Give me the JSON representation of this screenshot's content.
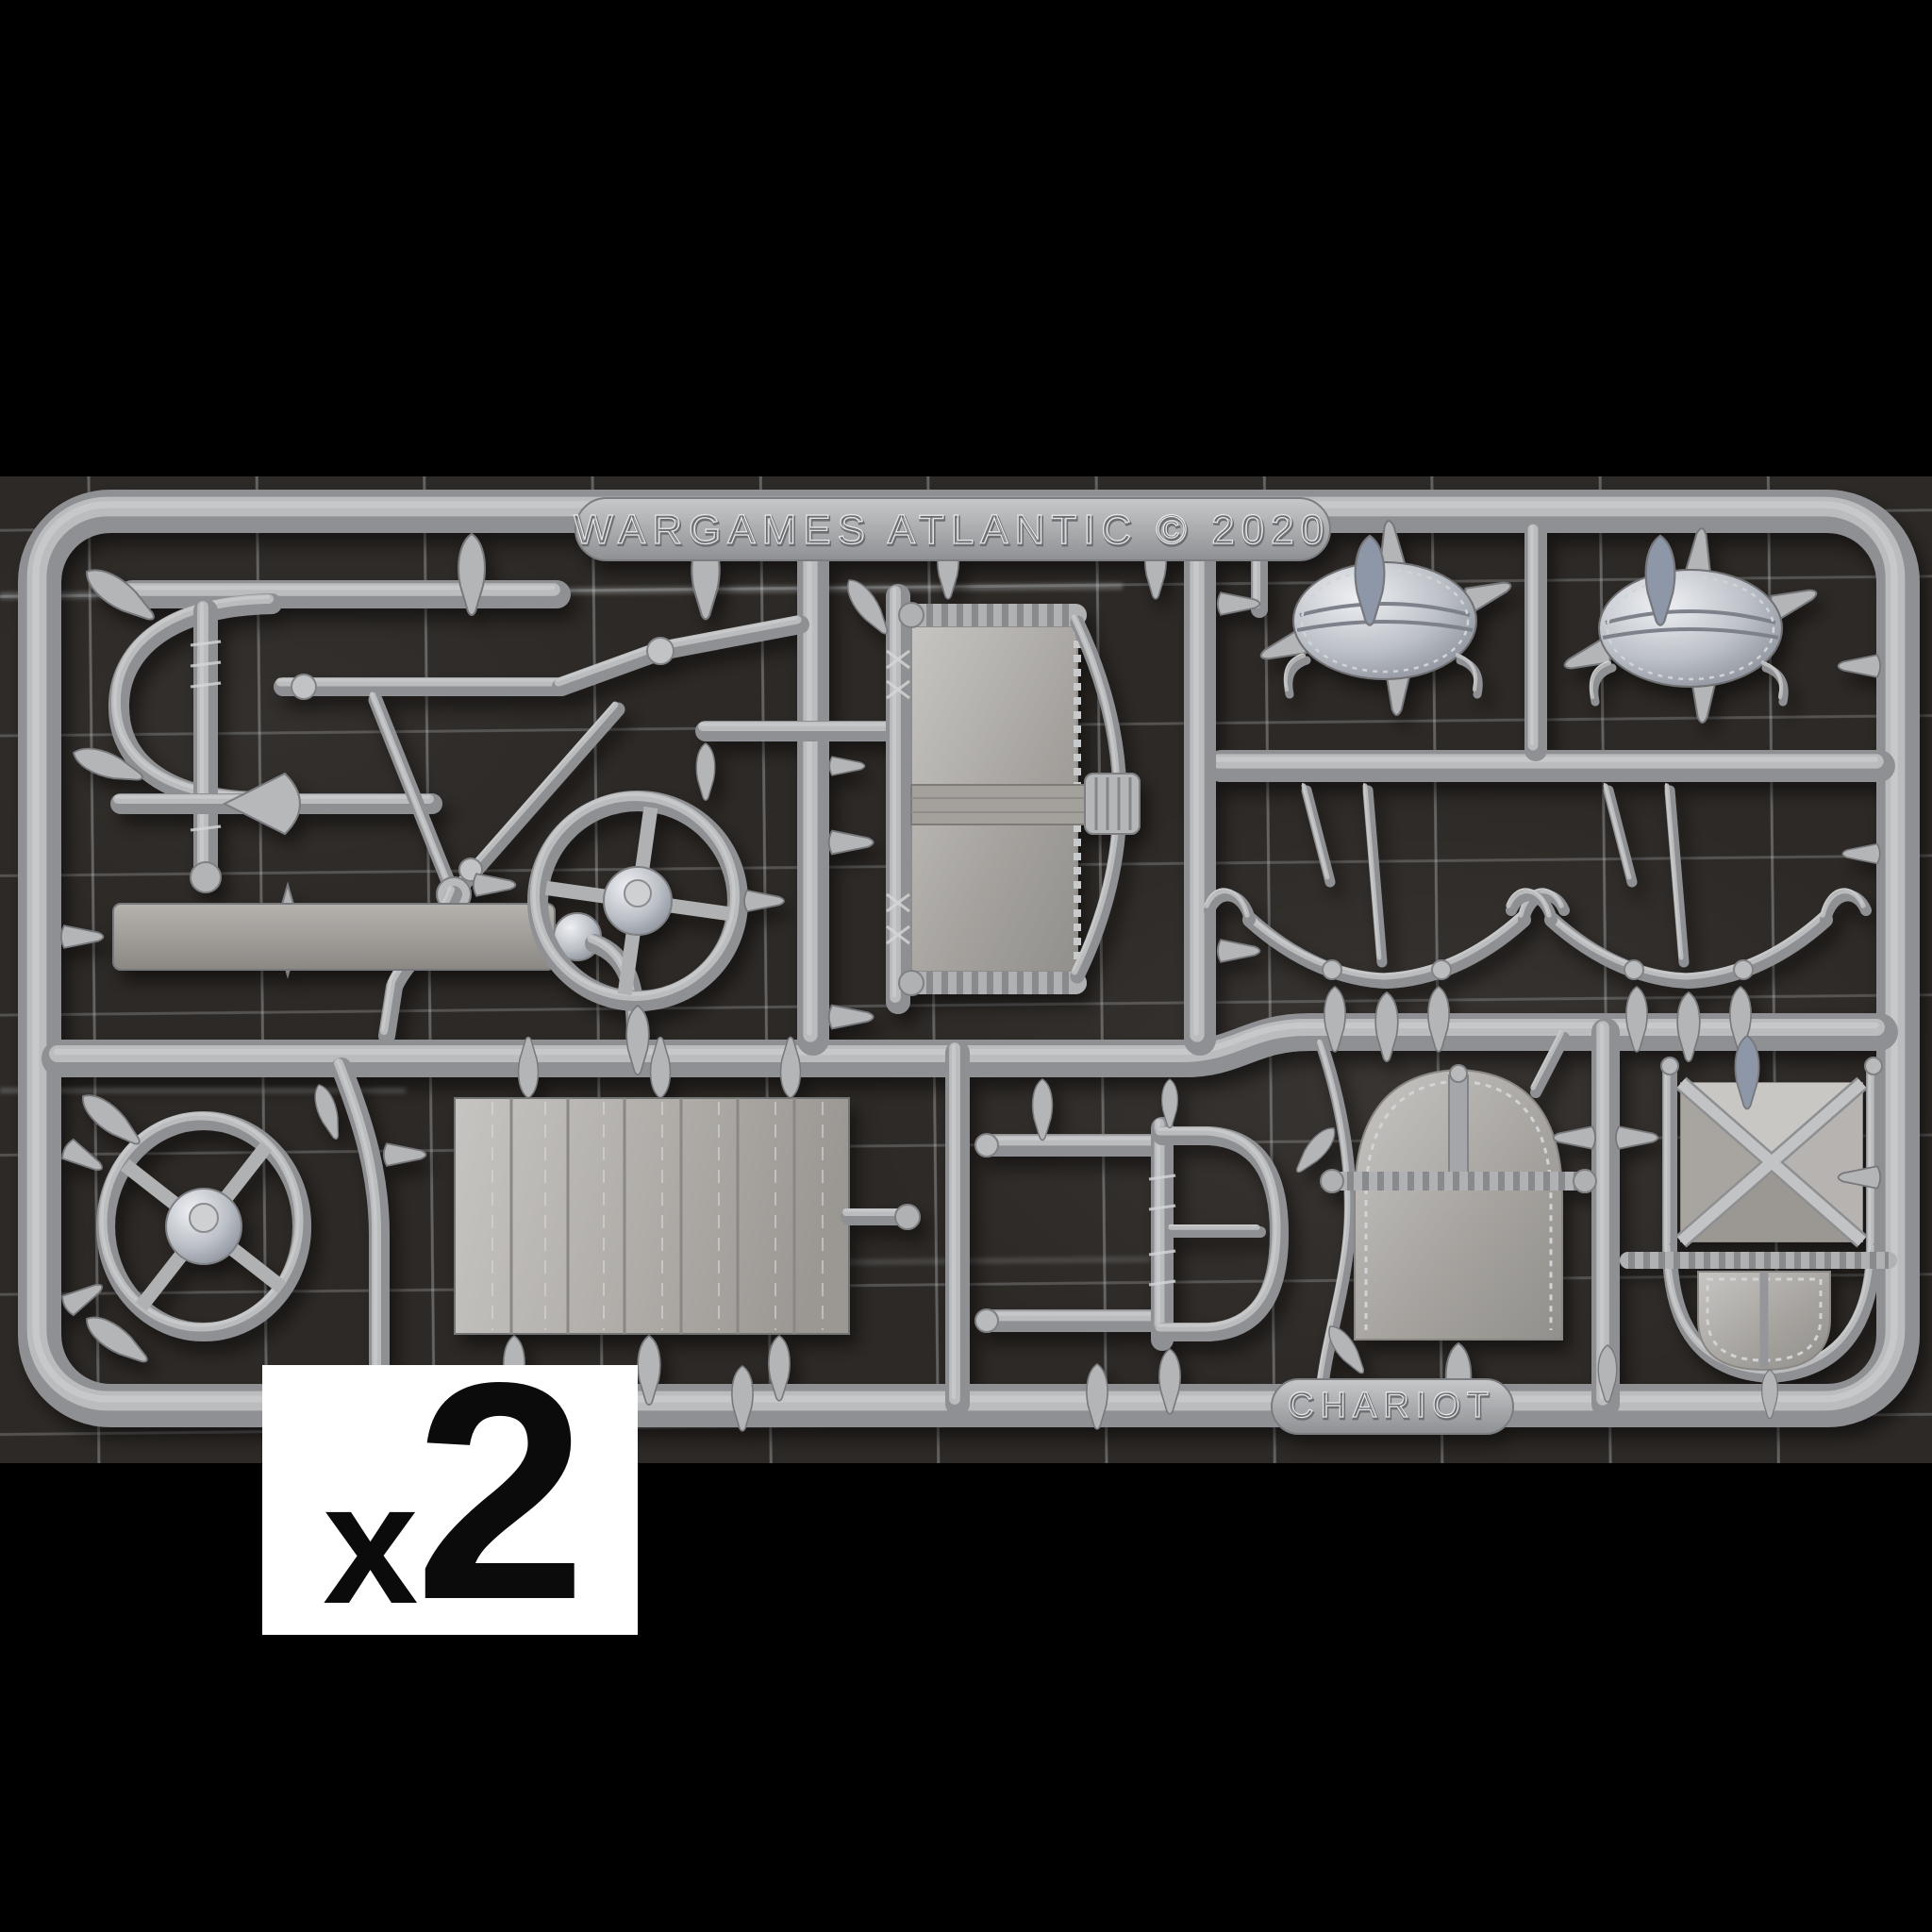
{
  "sprue": {
    "brand_tab_text": "WARGAMES ATLANTIC © 2020",
    "name_tab_text": "CHARIOT"
  },
  "quantity_label": {
    "prefix": "x",
    "value": "2"
  },
  "colors": {
    "background": "#000000",
    "cutting_mat": "#2d2926",
    "grid_line": "#aab0b3",
    "plastic": "#b3b4b6",
    "plastic_highlight": "#e6e7e9",
    "plastic_shadow": "#6f7073",
    "blue_gray_pin": "#8e97a7",
    "label_background": "#ffffff",
    "label_text": "#0b0b0b"
  }
}
